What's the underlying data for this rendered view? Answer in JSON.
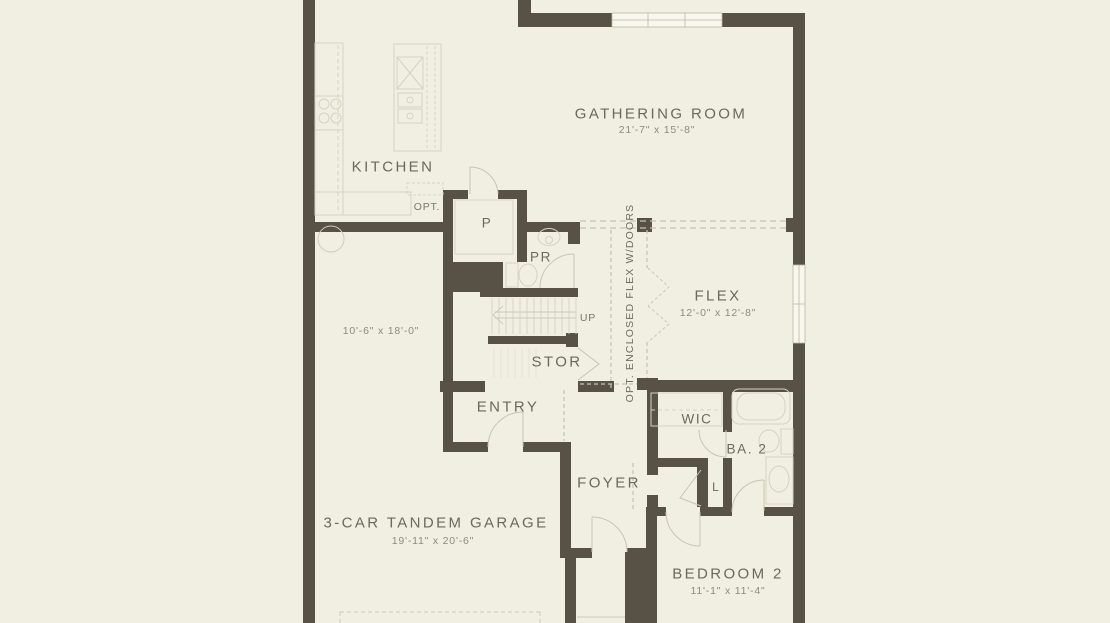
{
  "palette": {
    "background": "#f1eee2",
    "wall": "#585145",
    "fixture_line": "#d7d3c1",
    "dashed_line": "#c7c3b0",
    "label_text": "#6c685c",
    "dimension_text": "#8f8b7c",
    "window_fill": "#f8f6ed"
  },
  "rooms": {
    "kitchen": {
      "label": "KITCHEN"
    },
    "gathering_room": {
      "label": "GATHERING ROOM",
      "dimensions": "21'-7\" x 15'-8\""
    },
    "flex": {
      "label": "FLEX",
      "dimensions": "12'-0\" x 12'-8\""
    },
    "pantry": {
      "label": "P"
    },
    "powder_room": {
      "label": "PR"
    },
    "storage": {
      "label": "STOR"
    },
    "entry": {
      "label": "ENTRY"
    },
    "foyer": {
      "label": "FOYER"
    },
    "walk_in_closet": {
      "label": "WIC"
    },
    "bath_2": {
      "label": "BA. 2"
    },
    "linen_closet": {
      "label": "L"
    },
    "garage": {
      "label": "3-CAR TANDEM GARAGE",
      "dimensions": "19'-11\" x 20'-6\"",
      "tandem_bay_dimensions": "10'-6\" x 18'-0\""
    },
    "bedroom_2": {
      "label": "BEDROOM 2",
      "dimensions": "11'-1\" x 11'-4\""
    }
  },
  "annotations": {
    "stair_direction": "UP",
    "kitchen_option": "OPT.",
    "flex_option": "OPT. ENCLOSED FLEX W/DOORS"
  }
}
